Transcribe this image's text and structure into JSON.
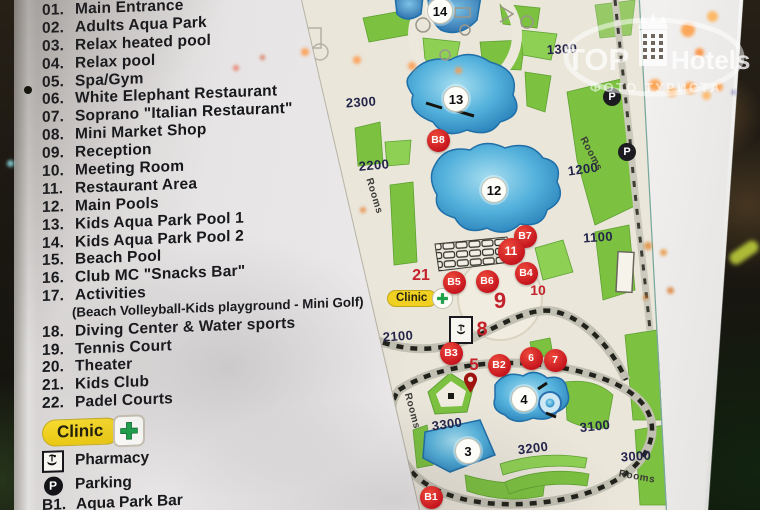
{
  "sign": {
    "legend": {
      "items": [
        {
          "num": "01.",
          "label": "Main Entrance"
        },
        {
          "num": "02.",
          "label": "Adults Aqua Park"
        },
        {
          "num": "03.",
          "label": "Relax heated pool"
        },
        {
          "num": "04.",
          "label": "Relax pool"
        },
        {
          "num": "05.",
          "label": "Spa/Gym"
        },
        {
          "num": "06.",
          "label": "White Elephant Restaurant"
        },
        {
          "num": "07.",
          "label": "Soprano \"Italian Restaurant\""
        },
        {
          "num": "08.",
          "label": "Mini Market Shop"
        },
        {
          "num": "09.",
          "label": "Reception"
        },
        {
          "num": "10.",
          "label": "Meeting Room"
        },
        {
          "num": "11.",
          "label": "Restaurant Area"
        },
        {
          "num": "12.",
          "label": "Main Pools"
        },
        {
          "num": "13.",
          "label": "Kids Aqua Park Pool 1"
        },
        {
          "num": "14.",
          "label": "Kids Aqua Park Pool 2"
        },
        {
          "num": "15.",
          "label": "Beach Pool"
        },
        {
          "num": "16.",
          "label": "Club MC \"Snacks Bar\""
        },
        {
          "num": "17.",
          "label": "Activities",
          "sub": "(Beach Volleyball-Kids playground - Mini Golf)"
        },
        {
          "num": "18.",
          "label": "Diving Center & Water sports"
        },
        {
          "num": "19.",
          "label": "Tennis Court"
        },
        {
          "num": "20.",
          "label": "Theater"
        },
        {
          "num": "21.",
          "label": "Kids Club"
        },
        {
          "num": "22.",
          "label": "Padel Courts"
        }
      ],
      "clinic_label": "Clinic",
      "pharmacy_label": "Pharmacy",
      "parking_label": "Parking",
      "parking_symbol": "P",
      "bars": [
        {
          "num": "B1.",
          "label": "Aqua Park Bar"
        },
        {
          "num": "B2.",
          "label": "Relax Pool Bar"
        }
      ]
    },
    "map": {
      "clinic_label": "Clinic",
      "parking_symbol": "P",
      "zone_labels": [
        {
          "text": "1300",
          "x": 562,
          "y": 49,
          "rot": -3
        },
        {
          "text": "2300",
          "x": 361,
          "y": 102,
          "rot": -4
        },
        {
          "text": "2200",
          "x": 374,
          "y": 165,
          "rot": -5
        },
        {
          "text": "1200",
          "x": 583,
          "y": 169,
          "rot": -8
        },
        {
          "text": "1100",
          "x": 598,
          "y": 237,
          "rot": -4
        },
        {
          "text": "2100",
          "x": 398,
          "y": 336,
          "rot": -4
        },
        {
          "text": "3300",
          "x": 447,
          "y": 424,
          "rot": -8
        },
        {
          "text": "3200",
          "x": 533,
          "y": 448,
          "rot": -7
        },
        {
          "text": "3100",
          "x": 595,
          "y": 426,
          "rot": -6
        },
        {
          "text": "3000",
          "x": 636,
          "y": 456,
          "rot": -4
        }
      ],
      "rooms_labels": [
        {
          "text": "Rooms",
          "x": 374,
          "y": 196,
          "rot": 73
        },
        {
          "text": "Rooms",
          "x": 591,
          "y": 154,
          "rot": 62
        },
        {
          "text": "Rooms",
          "x": 412,
          "y": 411,
          "rot": 75
        },
        {
          "text": "Rooms",
          "x": 637,
          "y": 477,
          "rot": 10
        }
      ],
      "pool_markers": [
        {
          "text": "14",
          "x": 439,
          "y": 10
        },
        {
          "text": "13",
          "x": 455,
          "y": 98
        },
        {
          "text": "12",
          "x": 493,
          "y": 189
        },
        {
          "text": "4",
          "x": 523,
          "y": 398
        },
        {
          "text": "3",
          "x": 467,
          "y": 450
        }
      ],
      "bar_markers": [
        {
          "text": "B8",
          "x": 438,
          "y": 140
        },
        {
          "text": "B7",
          "x": 525,
          "y": 236
        },
        {
          "text": "11",
          "x": 511,
          "y": 251,
          "size": 27
        },
        {
          "text": "B4",
          "x": 526,
          "y": 273
        },
        {
          "text": "B5",
          "x": 454,
          "y": 282
        },
        {
          "text": "B6",
          "x": 487,
          "y": 281
        },
        {
          "text": "B3",
          "x": 451,
          "y": 353
        },
        {
          "text": "B2",
          "x": 499,
          "y": 365
        },
        {
          "text": "6",
          "x": 531,
          "y": 358
        },
        {
          "text": "7",
          "x": 555,
          "y": 360
        },
        {
          "text": "B1",
          "x": 431,
          "y": 497
        }
      ],
      "area_numbers": [
        {
          "text": "21",
          "x": 421,
          "y": 276,
          "fs": 16
        },
        {
          "text": "10",
          "x": 538,
          "y": 290,
          "fs": 14
        },
        {
          "text": "9",
          "x": 500,
          "y": 301,
          "fs": 22
        },
        {
          "text": "8",
          "x": 482,
          "y": 330,
          "fs": 20
        },
        {
          "text": "5",
          "x": 474,
          "y": 365,
          "fs": 17
        }
      ],
      "parking_markers": [
        {
          "x": 612,
          "y": 97
        },
        {
          "x": 627,
          "y": 152
        }
      ]
    }
  },
  "watermark": {
    "brand_top": "TOP",
    "brand_hotels": "Hotels",
    "subtitle": "ФОТО ТУРИСТА"
  },
  "colors": {
    "marker_red": "#d2232a",
    "map_green": "#7cc140",
    "pool_blue": "#3a9ad0",
    "clinic_yellow": "#f0d020",
    "legend_text": "#17181c",
    "zone_label_navy": "#23244a"
  }
}
